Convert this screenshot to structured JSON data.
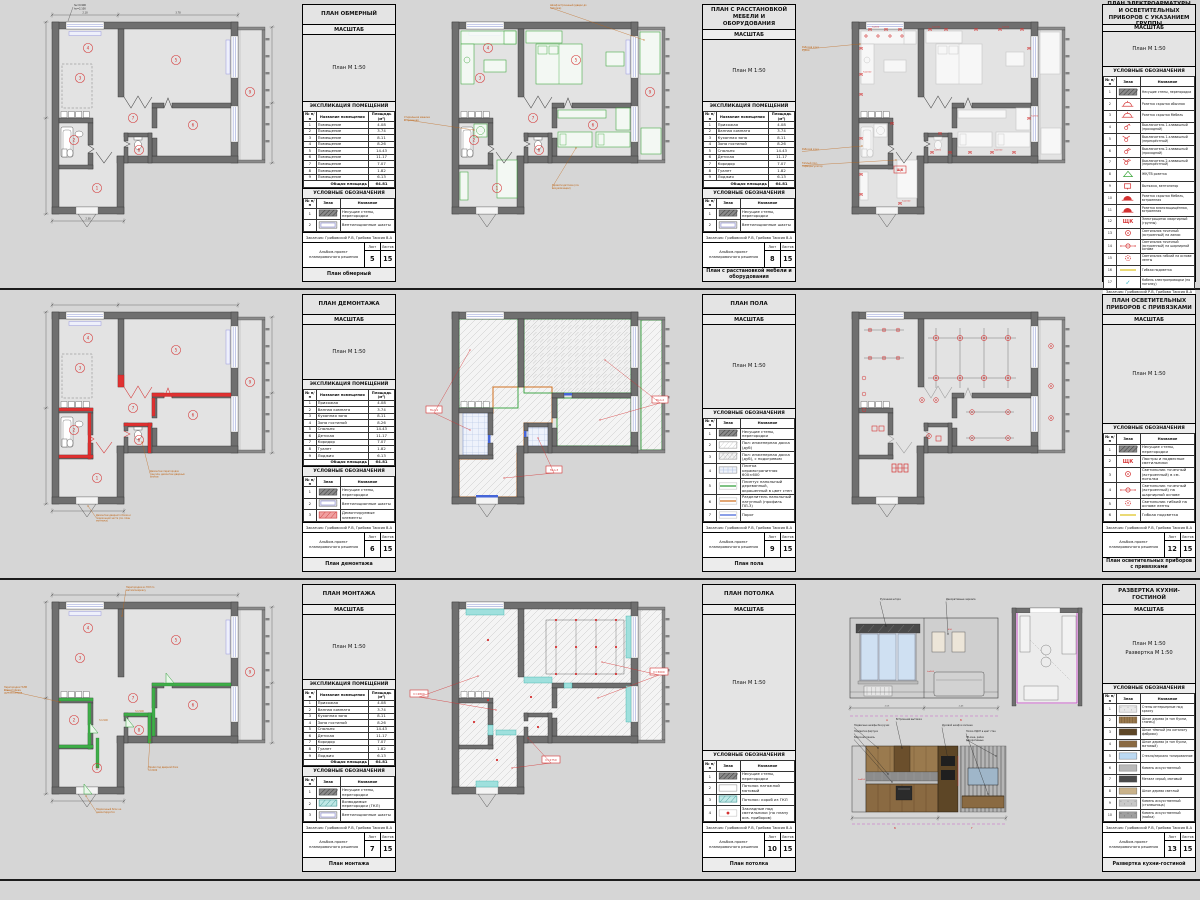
{
  "sheet": {
    "background": "#d6d6d6",
    "scale_header": "МАСШТАБ",
    "explication_title": "ЭКСПЛИКАЦИЯ ПОМЕЩЕНИЙ",
    "legend_title": "УСЛОВНЫЕ ОБОЗНАЧЕНИЯ",
    "expl_headers": [
      "№ п/п",
      "Название помещения",
      "Площадь (м²)"
    ],
    "legend_headers": [
      "№ п/п",
      "Знак",
      "Название"
    ],
    "total_label": "Общая площадь",
    "total_value": "64.81",
    "client": "Заказчик: Грибовский Р.В, Грибова Таисия В.А",
    "album": "Альбом-проект планировочного решения",
    "sheet_label": "Лист",
    "sheets_label": "Листов",
    "sheets_total": "15"
  },
  "generic_room_name": "Помещение",
  "rooms": [
    {
      "num": "1",
      "name": "Прихожая",
      "area": "4.08"
    },
    {
      "num": "2",
      "name": "Ванная комната",
      "area": "3.74"
    },
    {
      "num": "3",
      "name": "Кухонная зона",
      "area": "8.11"
    },
    {
      "num": "4",
      "name": "Зона гостиной",
      "area": "8.26"
    },
    {
      "num": "5",
      "name": "Спальня",
      "area": "14.43"
    },
    {
      "num": "6",
      "name": "Детская",
      "area": "11.17"
    },
    {
      "num": "7",
      "name": "Коридор",
      "area": "7.07"
    },
    {
      "num": "8",
      "name": "Туалет",
      "area": "1.82"
    },
    {
      "num": "9",
      "name": "Лоджия",
      "area": "6.13"
    }
  ],
  "colors": {
    "red": "#d43232",
    "green": "#3aa53a",
    "orange": "#bf6414",
    "teal": "#7fd4d0",
    "magenta": "#c95fc9",
    "window": "#a9b1e0",
    "wall": "#6f6f6f",
    "yellow": "#e3cf4a"
  },
  "panels": [
    {
      "title": "ПЛАН ОБМЕРНЫЙ",
      "caption": "План обмерный",
      "sheet": "5",
      "scale": [
        "План М 1:50"
      ],
      "type": "measure",
      "explication": "generic",
      "legend": [
        {
          "n": "1",
          "sym": "hatch",
          "label": "Несущие стены, перегородки"
        },
        {
          "n": "2",
          "sym": "vent",
          "label": "Вентиляционные шахты"
        }
      ],
      "notes": [
        "hн=0.900",
        "hо=2.100"
      ]
    },
    {
      "title": "ПЛАН С РАССТАНОВКОЙ МЕБЕЛИ И ОБОРУДОВАНИЯ",
      "caption": "План с расстановкой мебели и оборудования",
      "sheet": "8",
      "scale": [
        "План М 1:50"
      ],
      "type": "furniture",
      "explication": "named",
      "legend": [
        {
          "n": "1",
          "sym": "hatch",
          "label": "Несущие стены, перегородки"
        },
        {
          "n": "2",
          "sym": "vent",
          "label": "Вентиляционные шахты"
        }
      ],
      "notes": [
        "Шкаф встроенный (двери до потолка)",
        "Стиральная машина встроенная",
        "Кровати детские (см. визуализации)"
      ]
    },
    {
      "title": "ПЛАН ЭЛЕКТРОАРМАТУРЫ И ОСВЕТИТЕЛЬНЫХ ПРИБОРОВ С УКАЗАНИЕМ ГРУППЫ",
      "caption": "План электроарматуры и осветительных приборов с ук. группы",
      "sheet": "11",
      "scale": [
        "План М 1:50"
      ],
      "type": "electric",
      "explication": null,
      "legend": [
        {
          "n": "1",
          "sym": "hatch",
          "label": "Несущие стены, перегородки"
        },
        {
          "n": "2",
          "sym": "lamp",
          "label": "Розетка скрытая обычная"
        },
        {
          "n": "3",
          "sym": "lamp",
          "label": "Розетка скрытая Мебель"
        },
        {
          "n": "4",
          "sym": "sw1",
          "label": "Выключатель 1-клавишный (проходной)"
        },
        {
          "n": "5",
          "sym": "sw1x",
          "label": "Выключатель 1-клавишный (перекрёстный)"
        },
        {
          "n": "6",
          "sym": "sw2",
          "label": "Выключатель 2-клавишный (проходной)"
        },
        {
          "n": "7",
          "sym": "sw2x",
          "label": "Выключатель 2-клавишный (перекрёстный)"
        },
        {
          "n": "8",
          "sym": "tri",
          "label": "ЖК/ТВ розетка"
        },
        {
          "n": "9",
          "sym": "sqr",
          "label": "Вытяжка, вентилятор"
        },
        {
          "n": "10",
          "sym": "lampf",
          "label": "Розетка скрытая Мебель, встроенная"
        },
        {
          "n": "11",
          "sym": "lampf",
          "label": "Розетка влагозащищённая, встроенная"
        },
        {
          "n": "12",
          "sym": "shch",
          "label": "Электрощиток квартирный (группы)"
        },
        {
          "n": "13",
          "sym": "spot",
          "label": "Светильник точечный (встроенный) на линии"
        },
        {
          "n": "14",
          "sym": "spot2",
          "label": "Светильник точечный (встроенный) на шарнирной основе"
        },
        {
          "n": "15",
          "sym": "spot3",
          "label": "Светильник гибкий на основе ленты"
        },
        {
          "n": "16",
          "sym": "yline",
          "label": "Гибкая подсветка"
        },
        {
          "n": "17",
          "sym": "check",
          "label": "Кабель электропроводки (по потолку)"
        }
      ],
      "notes": [
        "Рабочая зона кухни",
        "Рабочая зона",
        "Тёплый пол, терморегулятор"
      ],
      "htags": [
        "h=300",
        "h=900",
        "h=1100",
        "h=2000",
        "h=600",
        "h=750"
      ]
    },
    {
      "title": "ПЛАН ДЕМОНТАЖА",
      "caption": "План демонтажа",
      "sheet": "6",
      "scale": [
        "План М 1:50"
      ],
      "type": "demolition",
      "explication": "named",
      "legend": [
        {
          "n": "1",
          "sym": "hatch",
          "label": "Несущие стены, перегородки"
        },
        {
          "n": "2",
          "sym": "vent",
          "label": "Вентиляционные шахты"
        },
        {
          "n": "3",
          "sym": "redfill",
          "label": "Демонтируемые элементы"
        }
      ],
      "notes": [
        "Демонтаж перегородок санузла, демонтаж дверных блоков",
        "Демонтаж дверного блока и подоконной части (см. план монтажа)"
      ]
    },
    {
      "title": "ПЛАН ПОЛА",
      "caption": "План пола",
      "sheet": "9",
      "scale": [
        "План М 1:50"
      ],
      "type": "floor",
      "explication": null,
      "legend": [
        {
          "n": "1",
          "sym": "hatch",
          "label": "Несущие стены, перегородки"
        },
        {
          "n": "2",
          "sym": "diag",
          "label": "Пол: инженерная доска (дуб)"
        },
        {
          "n": "3",
          "sym": "diag2",
          "label": "Пол: инженерная доска (дуб), с подогревом"
        },
        {
          "n": "4",
          "sym": "tile",
          "label": "Плитка керамогранитная 600×600"
        },
        {
          "n": "5",
          "sym": "line:#2f9e38",
          "label": "Плинтус напольный деревянный, окрашенный в цвет стен"
        },
        {
          "n": "6",
          "sym": "line:#d07020",
          "label": "Разделитель напольный латунный (профиль ПЛ-3)"
        },
        {
          "n": "7",
          "sym": "line:#4565d8",
          "label": "Порог"
        }
      ],
      "notes": [
        "Пол-1",
        "Пол-2",
        "Пол-3"
      ]
    },
    {
      "title": "ПЛАН ОСВЕТИТЕЛЬНЫХ ПРИБОРОВ С ПРИВЯЗКАМИ",
      "caption": "План осветительных приборов с привязками",
      "sheet": "12",
      "scale": [
        "План М 1:50"
      ],
      "type": "lighting",
      "explication": null,
      "legend": [
        {
          "n": "1",
          "sym": "hatch",
          "label": "Несущие стены, перегородки"
        },
        {
          "n": "2",
          "sym": "shch",
          "label": "Люстры и подвесные светильники"
        },
        {
          "n": "3",
          "sym": "spot",
          "label": "Светильник точечный (встроенный) в см. потолка"
        },
        {
          "n": "4",
          "sym": "spot2",
          "label": "Светильник точечный (встроенный) на шарнирной основе"
        },
        {
          "n": "5",
          "sym": "spot3",
          "label": "Светильник гибкий на основе ленты"
        },
        {
          "n": "6",
          "sym": "yline",
          "label": "Гибкая подсветка"
        }
      ],
      "notes": []
    },
    {
      "title": "ПЛАН МОНТАЖА",
      "caption": "План монтажа",
      "sheet": "7",
      "scale": [
        "План М 1:50"
      ],
      "type": "montage",
      "explication": "named",
      "legend": [
        {
          "n": "1",
          "sym": "hatch",
          "label": "Несущие стены, перегородки"
        },
        {
          "n": "2",
          "sym": "tealfill",
          "label": "Возводимые перегородки (ГКЛ)"
        },
        {
          "n": "3",
          "sym": "vent",
          "label": "Вентиляционные шахты"
        }
      ],
      "notes": [
        "Перегородка из ГКЛ по металлокаркасу",
        "Перегородка ГКЛВ влагостойкая, шумоизоляция",
        "Проём под дверной блок h=2100",
        "Подоконный блок не демонтируется"
      ],
      "htags": [
        "h=2100",
        "h=2100"
      ]
    },
    {
      "title": "ПЛАН ПОТОЛКА",
      "caption": "План потолка",
      "sheet": "10",
      "scale": [
        "План М 1:50"
      ],
      "type": "ceiling",
      "explication": null,
      "legend": [
        {
          "n": "1",
          "sym": "hatch",
          "label": "Несущие стены, перегородки"
        },
        {
          "n": "2",
          "sym": "white",
          "label": "Потолок натяжной матовый"
        },
        {
          "n": "3",
          "sym": "tealfill",
          "label": "Потолок: короб из ГКЛ"
        },
        {
          "n": "4",
          "sym": "reddot",
          "label": "Закладные под светильники (по плану осв. приборов)"
        }
      ],
      "notes": [
        "h=2800",
        "h=3000",
        "h=2750"
      ]
    },
    {
      "title": "РАЗВЕРТКА КУХНИ-ГОСТИНОЙ",
      "caption": "Развертка кухни-гостиной",
      "sheet": "13",
      "scale": [
        "План М 1:50",
        "Развертка М 1:50"
      ],
      "type": "elevation",
      "explication": null,
      "legend": [
        {
          "n": "1",
          "sym": "speckle",
          "label": "Стены интерьерные под краску"
        },
        {
          "n": "2",
          "sym": "woodtex",
          "label": "Шпон дерева (в тон Кухни, глянец)"
        },
        {
          "n": "3",
          "sym": "color:#5d4626",
          "label": "Шпон тёмный (по каталогу фабрики)"
        },
        {
          "n": "4",
          "sym": "color:#8a6a42",
          "label": "Шпон дерева (в тон Кухни, матовый)"
        },
        {
          "n": "5",
          "sym": "color:#bcd9f2",
          "label": "Стекло/зеркало тонированное"
        },
        {
          "n": "6",
          "sym": "color:#b9b9b9",
          "label": "Камень искусственный"
        },
        {
          "n": "7",
          "sym": "color:#4a4a4a",
          "label": "Металл серый, матовый"
        },
        {
          "n": "8",
          "sym": "color:#c9b28a",
          "label": "Шпон дерева светлый"
        },
        {
          "n": "9",
          "sym": "speckleg",
          "label": "Камень искусственный (столешница)"
        },
        {
          "n": "10",
          "sym": "speckled",
          "label": "Камень искусственный (мойка)"
        }
      ],
      "notes_top": [
        "Рулонная штора",
        "Декоративные зеркала"
      ],
      "notes": [
        "Встроенная вытяжка",
        "Подвесные шкафы без ручек",
        "Подсветка фартука",
        "Варочная панель",
        "Духовой шкаф в колонне",
        "Полка ЛДСП в цвет стен",
        "ТВ-зона, рейки декоративные"
      ]
    }
  ]
}
